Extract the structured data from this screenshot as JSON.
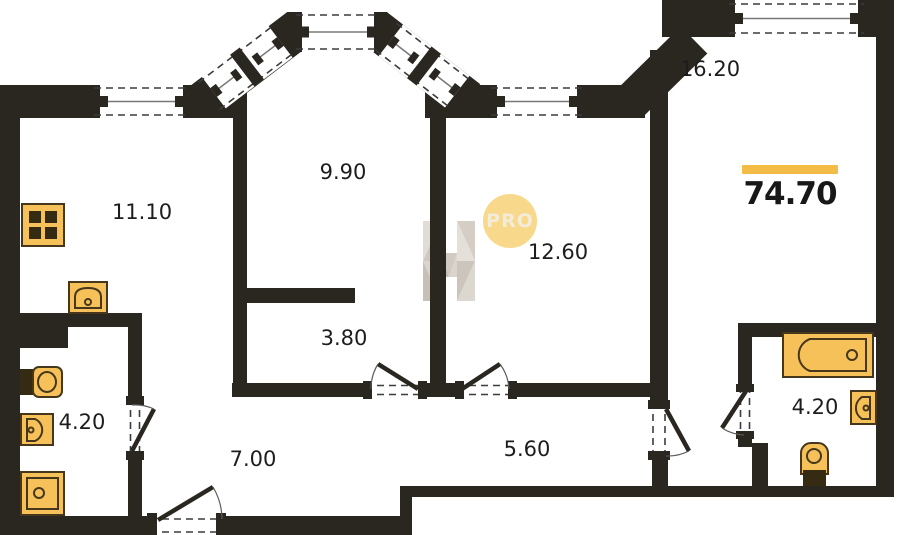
{
  "rooms": [
    {
      "area": "11.10"
    },
    {
      "area": "9.90"
    },
    {
      "area": "12.60"
    },
    {
      "area": "16.20"
    },
    {
      "area": "3.80"
    },
    {
      "area": "4.20"
    },
    {
      "area": "7.00"
    },
    {
      "area": "5.60"
    },
    {
      "area": "4.20"
    }
  ],
  "total": {
    "area": "74.70"
  },
  "watermark": {
    "logo_text": "PRO",
    "builder_letter": "H"
  },
  "fixtures": [
    "stove-icon",
    "kitchen-sink-icon",
    "toilet-icon",
    "washbasin-icon",
    "washing-machine-icon",
    "bathtub-icon",
    "sink-icon",
    "toilet-icon"
  ],
  "colors": {
    "wall": "#2a2620",
    "fixture-fill": "#f6c158",
    "fixture-stroke": "#46371c",
    "accent": "#f2bc47",
    "pro-fill": "#f8d88a",
    "pro-text": "#f3ecd9",
    "label": "#1d1d1d"
  }
}
